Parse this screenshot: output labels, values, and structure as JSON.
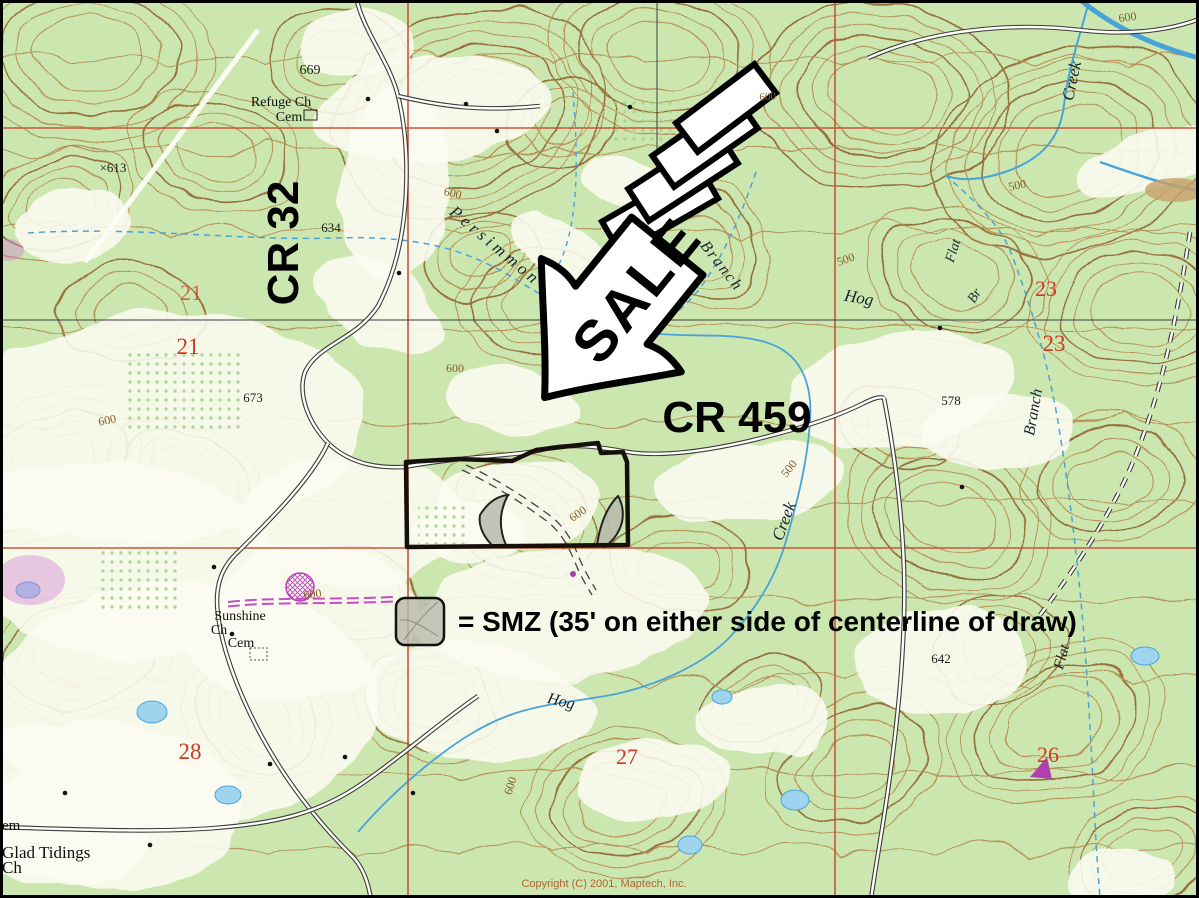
{
  "map": {
    "background_color": "#cbe7af",
    "clearing_color": "#fcfcf2",
    "contour_color": "#a8743c",
    "grid_color": "#c8553a",
    "water_color": "#4aa3d8",
    "labels": [
      {
        "text": "669",
        "x": 310,
        "y": 74,
        "cls": "elev",
        "fs": 14
      },
      {
        "text": "Refuge Ch",
        "x": 281,
        "y": 106,
        "cls": "place",
        "fs": 14
      },
      {
        "text": "Cem",
        "x": 289,
        "y": 121,
        "cls": "place",
        "fs": 14
      },
      {
        "text": "×613",
        "x": 113,
        "y": 172,
        "cls": "elev",
        "fs": 13
      },
      {
        "text": "634",
        "x": 331,
        "y": 232,
        "cls": "elev",
        "fs": 13
      },
      {
        "text": "CR 32",
        "x": 298,
        "y": 243,
        "rot": -90,
        "cls": "road",
        "fs": 44
      },
      {
        "text": "21",
        "x": 191,
        "y": 300,
        "cls": "section",
        "fs": 22,
        "op": 0.75
      },
      {
        "text": "21",
        "x": 188,
        "y": 354,
        "cls": "section",
        "fs": 23
      },
      {
        "text": "673",
        "x": 253,
        "y": 402,
        "cls": "elev",
        "fs": 13
      },
      {
        "text": "600",
        "x": 108,
        "y": 424,
        "rot": -12,
        "cls": "contour",
        "fs": 12
      },
      {
        "text": "Persimmon",
        "x": 492,
        "y": 250,
        "rot": 40,
        "cls": "stream",
        "fs": 17,
        "ls": 4
      },
      {
        "text": "Branch",
        "x": 718,
        "y": 269,
        "rot": 52,
        "cls": "stream",
        "fs": 16,
        "ls": 2
      },
      {
        "text": "600",
        "x": 452,
        "y": 197,
        "rot": 12,
        "cls": "contour",
        "fs": 12
      },
      {
        "text": "600",
        "x": 455,
        "y": 372,
        "cls": "contour",
        "fs": 12
      },
      {
        "text": "Hog",
        "x": 858,
        "y": 303,
        "rot": 10,
        "cls": "stream",
        "fs": 17
      },
      {
        "text": "500",
        "x": 847,
        "y": 263,
        "rot": -20,
        "cls": "contour",
        "fs": 12
      },
      {
        "text": "Flat",
        "x": 957,
        "y": 252,
        "rot": -72,
        "cls": "stream",
        "fs": 14
      },
      {
        "text": "Br",
        "x": 978,
        "y": 298,
        "rot": -58,
        "cls": "stream",
        "fs": 14
      },
      {
        "text": "Creek",
        "x": 1077,
        "y": 82,
        "rot": -78,
        "cls": "stream",
        "fs": 17
      },
      {
        "text": "600",
        "x": 1128,
        "y": 21,
        "rot": -8,
        "cls": "contour",
        "fs": 12
      },
      {
        "text": "600",
        "x": 768,
        "y": 100,
        "rot": -5,
        "cls": "contour",
        "fs": 11
      },
      {
        "text": "500",
        "x": 1018,
        "y": 189,
        "rot": -12,
        "cls": "contour",
        "fs": 12
      },
      {
        "text": "23",
        "x": 1046,
        "y": 296,
        "cls": "section",
        "fs": 22
      },
      {
        "text": "23",
        "x": 1054,
        "y": 351,
        "cls": "section",
        "fs": 23
      },
      {
        "text": "Branch",
        "x": 1038,
        "y": 413,
        "rot": -80,
        "cls": "stream",
        "fs": 16
      },
      {
        "text": "CR 459",
        "x": 737,
        "y": 432,
        "cls": "road",
        "fs": 44
      },
      {
        "text": "578",
        "x": 951,
        "y": 405,
        "cls": "elev",
        "fs": 13
      },
      {
        "text": "500",
        "x": 792,
        "y": 471,
        "rot": -52,
        "cls": "contour",
        "fs": 12
      },
      {
        "text": "Creek",
        "x": 789,
        "y": 523,
        "rot": -70,
        "cls": "stream",
        "fs": 17
      },
      {
        "text": "600",
        "x": 580,
        "y": 517,
        "rot": -35,
        "cls": "contour",
        "fs": 12
      },
      {
        "text": "Sunshine",
        "x": 240,
        "y": 620,
        "cls": "place",
        "fs": 14
      },
      {
        "text": "Ch",
        "x": 219,
        "y": 634,
        "cls": "place",
        "fs": 14
      },
      {
        "text": "Cem",
        "x": 241,
        "y": 647,
        "cls": "place",
        "fs": 14
      },
      {
        "text": "600",
        "x": 313,
        "y": 598,
        "rot": -8,
        "cls": "contour",
        "fs": 12
      },
      {
        "text": "642",
        "x": 941,
        "y": 663,
        "cls": "elev",
        "fs": 13
      },
      {
        "text": "Flat",
        "x": 1066,
        "y": 658,
        "rot": -75,
        "cls": "stream",
        "fs": 15
      },
      {
        "text": "27",
        "x": 627,
        "y": 764,
        "cls": "section",
        "fs": 22
      },
      {
        "text": "28",
        "x": 190,
        "y": 759,
        "cls": "section",
        "fs": 23
      },
      {
        "text": "26",
        "x": 1048,
        "y": 762,
        "cls": "section",
        "fs": 22
      },
      {
        "text": "600",
        "x": 514,
        "y": 787,
        "rot": -72,
        "cls": "contour",
        "fs": 12
      },
      {
        "text": "Hog",
        "x": 560,
        "y": 706,
        "rot": 14,
        "cls": "stream",
        "fs": 16
      },
      {
        "text": "em",
        "x": 2,
        "y": 830,
        "cls": "place",
        "fs": 15,
        "an": "start"
      },
      {
        "text": "Glad Tidings",
        "x": 2,
        "y": 858,
        "cls": "place",
        "fs": 17,
        "an": "start"
      },
      {
        "text": "Ch",
        "x": 2,
        "y": 873,
        "cls": "place",
        "fs": 17,
        "an": "start"
      },
      {
        "text": "Copyright (C) 2001, Maptech, Inc.",
        "x": 604,
        "y": 887,
        "cls": "copyright",
        "fs": 11
      }
    ]
  },
  "sale_arrow": {
    "label": "SALE",
    "fill": "#ffffff",
    "outline": "#000000"
  },
  "property": {
    "outline_color": "#17100a"
  },
  "smz": {
    "legend_text": "= SMZ (35' on either side of centerline of draw)",
    "swatch_color": "#b9b9ad"
  },
  "copyright": {
    "text": "Copyright (C) 2001, Maptech, Inc."
  }
}
